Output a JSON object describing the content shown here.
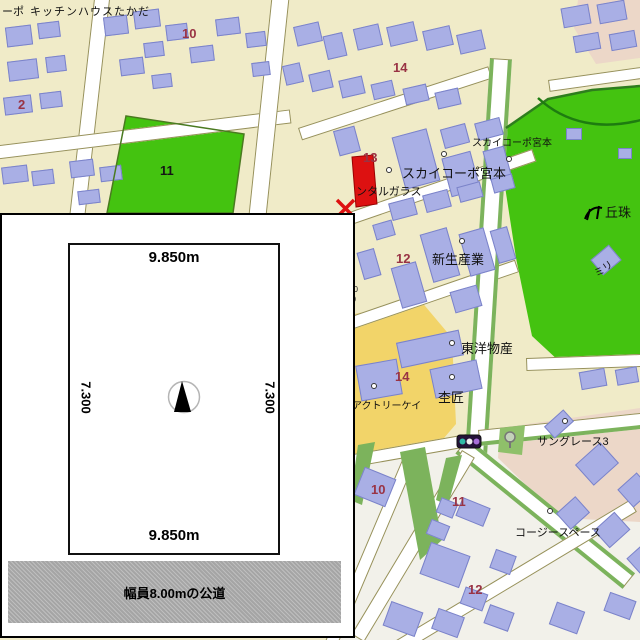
{
  "map": {
    "labels": {
      "corp_partial": "ーポ",
      "kitchen_house": "キッチンハウスたかだ",
      "num_10_top": "10",
      "num_2": "2",
      "num_11_park": "11",
      "num_14_top": "14",
      "num_13": "13",
      "sky_corp_small": "スカイコーポ宮本",
      "sky_corp_large": "スカイコーポ宮本",
      "rental_glass": "ンタルガラス",
      "okadama_park": "丘珠",
      "miri_partial": "ミリ",
      "shinsei_sangyo": "新生産業",
      "num_12_mid": "12",
      "tiny_line1": "20",
      "tiny_line2": "10",
      "toyo_bussan": "東洋物産",
      "num_14_mid": "14",
      "mokusho": "杢匠",
      "factory_kei": "アクトリーケイ",
      "sun_grace": "サングレース3",
      "num_11_bottom": "11",
      "cozy_space": "コージースペース",
      "num_10_bottom": "10",
      "num_12_bottom": "12"
    },
    "icons": {
      "traffic_light": "traffic-light-icon",
      "park_facility": "playground-icon",
      "tree": "tree-icon",
      "poi_dot": "poi-dot",
      "subject_marker": "red-x-marker"
    },
    "colors": {
      "block_cream": "#f0ebc8",
      "building": "#a9afe5",
      "park_green": "#44c310",
      "yellow_block": "#f2d469",
      "pink_block": "#ecd7c8",
      "number_label": "#993344",
      "subject_red": "#dd1111"
    }
  },
  "inset": {
    "top_dimension": "9.850m",
    "bottom_dimension": "9.850m",
    "left_dimension": "7.300",
    "right_dimension": "7.300",
    "road_note": "幅員8.00mの公道"
  }
}
